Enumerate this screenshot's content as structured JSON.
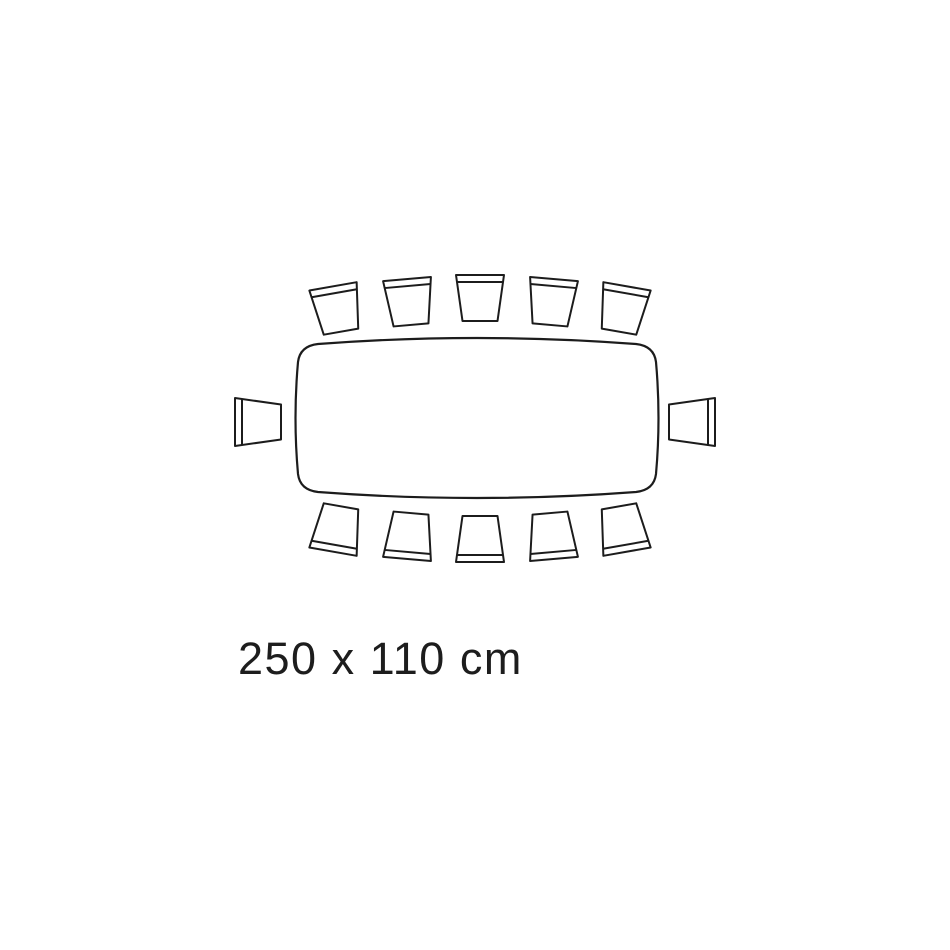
{
  "page": {
    "background_color": "#ffffff",
    "line_color": "#1c1c1c"
  },
  "diagram": {
    "type": "table-seating-plan",
    "label": "250 x 110 cm",
    "table": {
      "shape": "boat-shaped rounded rectangle",
      "width_cm": 250,
      "depth_cm": 110
    },
    "seat_count": 12,
    "seats": [
      {
        "id": "top-1",
        "side": "top",
        "cx": 337,
        "cy": 309,
        "rotation": -10
      },
      {
        "id": "top-2",
        "side": "top",
        "cx": 408.5,
        "cy": 302,
        "rotation": -5
      },
      {
        "id": "top-3",
        "side": "top",
        "cx": 480,
        "cy": 298,
        "rotation": 0
      },
      {
        "id": "top-4",
        "side": "top",
        "cx": 551.5,
        "cy": 302,
        "rotation": 5
      },
      {
        "id": "top-5",
        "side": "top",
        "cx": 623,
        "cy": 309,
        "rotation": 10
      },
      {
        "id": "bottom-1",
        "side": "bottom",
        "cx": 337,
        "cy": 529,
        "rotation": 190
      },
      {
        "id": "bottom-2",
        "side": "bottom",
        "cx": 408.5,
        "cy": 536,
        "rotation": 185
      },
      {
        "id": "bottom-3",
        "side": "bottom",
        "cx": 480,
        "cy": 539,
        "rotation": 180
      },
      {
        "id": "bottom-4",
        "side": "bottom",
        "cx": 551.5,
        "cy": 536,
        "rotation": 175
      },
      {
        "id": "bottom-5",
        "side": "bottom",
        "cx": 623,
        "cy": 529,
        "rotation": 170
      },
      {
        "id": "left-1",
        "side": "left",
        "cx": 258,
        "cy": 422,
        "rotation": -90
      },
      {
        "id": "right-1",
        "side": "right",
        "cx": 692,
        "cy": 422,
        "rotation": 90
      }
    ]
  }
}
